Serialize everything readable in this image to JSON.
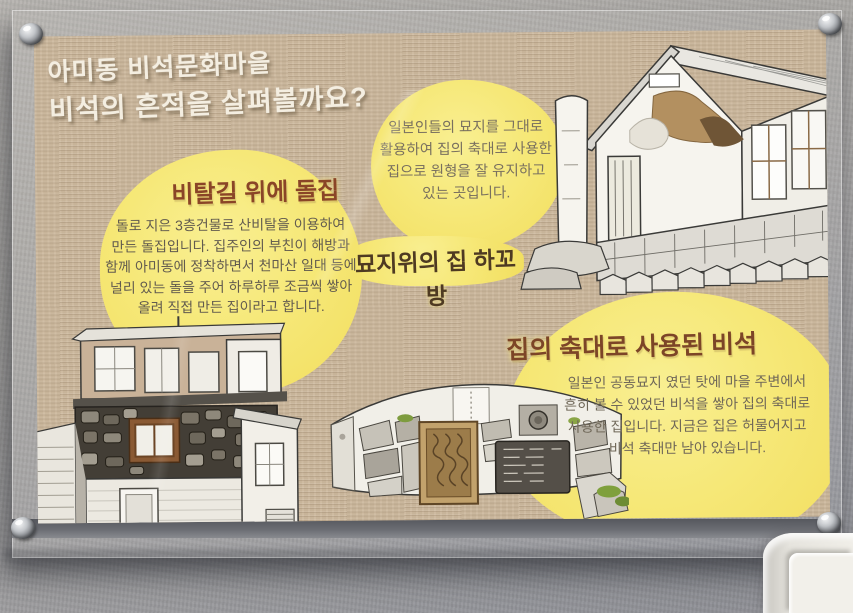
{
  "scene": {
    "wall_color": "#a7a5a2",
    "panel": "clear-acrylic-with-standoffs",
    "accent_yellow": "#f5e470",
    "poster_background": "#cbb79c"
  },
  "poster": {
    "title": {
      "line1": "아미동 비석문화마을",
      "line2": "비석의 흔적을 살펴볼까요?",
      "color": "#f4eee1"
    },
    "hakobang": {
      "label": "묘지위의 집 하꼬방",
      "note_lines": [
        "일본인들의 묘지를 그대로",
        "활용하여 집의 축대로 사용한",
        "집으로 원형을 잘 유지하고",
        "있는 곳입니다."
      ],
      "illustration": "hakobang-house-sketch"
    },
    "stone_house": {
      "heading": "비탈길 위에 돌집",
      "heading_color": "#8a4527",
      "body_lines": [
        "돌로 지은 3층건물로 산비탈을 이용하여",
        "만든 돌집입니다. 집주인의 부친이 해방과",
        "함께 아미동에 정착하면서 천마산 일대 등에",
        "널리 있는 돌을 주어 하루하루 조금씩 쌓아",
        "올려 직접 만든 집이라고 합니다."
      ],
      "illustration": "stone-house-sketch"
    },
    "biseok": {
      "heading": "집의 축대로 사용된 비석",
      "heading_color": "#7c4527",
      "body_lines": [
        "일본인 공동묘지 였던 탓에 마을 주변에서",
        "흔히 볼 수 있었던 비석을 쌓아 집의 축대로",
        "사용한 집입니다. 지금은 집은 허물어지고",
        "비석 축대만 남아 있습니다."
      ],
      "illustration": "tombstone-wall-sketch"
    }
  }
}
